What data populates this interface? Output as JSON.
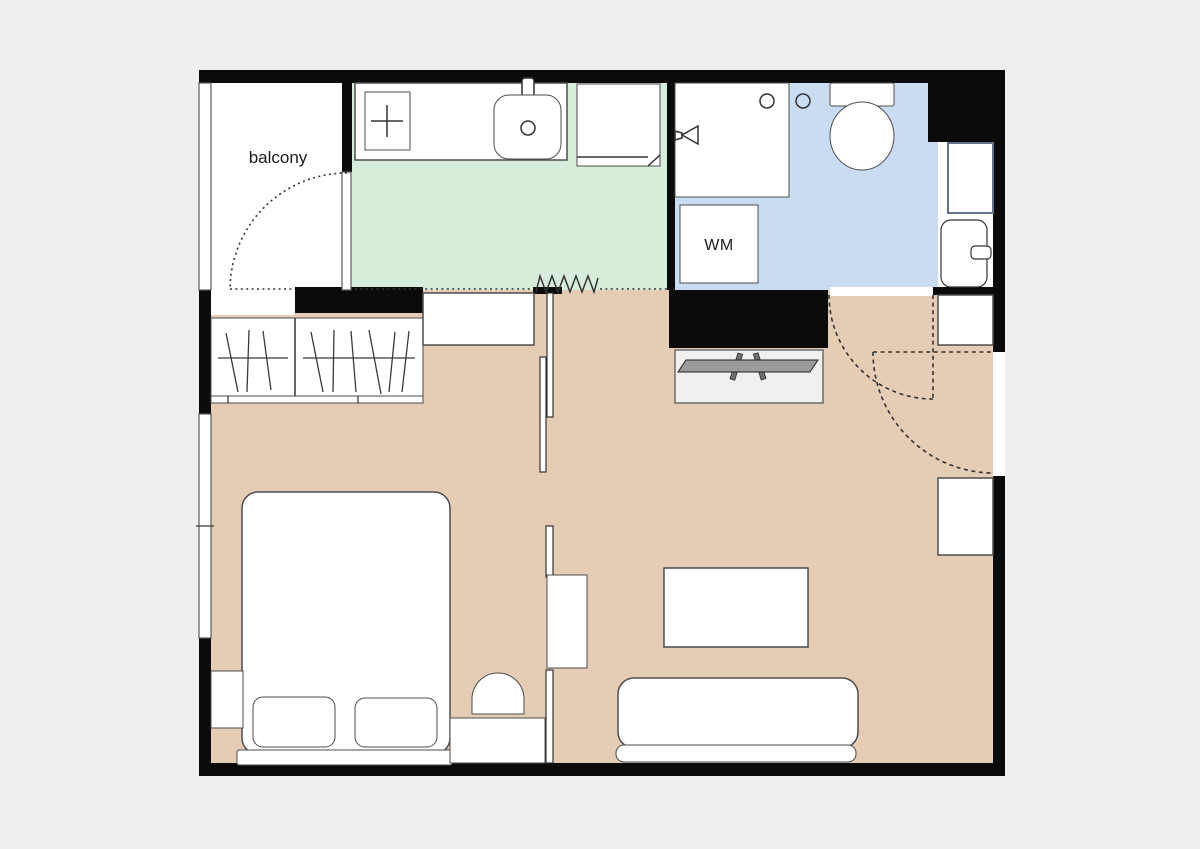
{
  "plan": {
    "labels": {
      "balcony": "balcony",
      "washing_machine": "WM"
    },
    "colors": {
      "page_background": "#edeff1",
      "wall": "#0b0b0b",
      "living_floor": "#e5cdb5",
      "kitchen_floor": "#d7ecd9",
      "bathroom_floor": "#c9dcf1",
      "balcony_floor": "#ffffff",
      "niche_floor": "#ffffff",
      "furniture_fill": "#ffffff",
      "furniture_outline": "#4d4d4d",
      "tv_fill": "#9b9b9b",
      "tv_board_fill": "#f0f0f0",
      "shelf_outline": "#64748b",
      "annotation_line": "#333333"
    },
    "rooms": [
      {
        "name": "balcony",
        "label_shown": true
      },
      {
        "name": "kitchen",
        "label_shown": false
      },
      {
        "name": "bathroom",
        "label_shown": false
      },
      {
        "name": "hall",
        "label_shown": false
      },
      {
        "name": "living-room",
        "label_shown": false
      },
      {
        "name": "bedroom",
        "label_shown": false
      }
    ]
  }
}
